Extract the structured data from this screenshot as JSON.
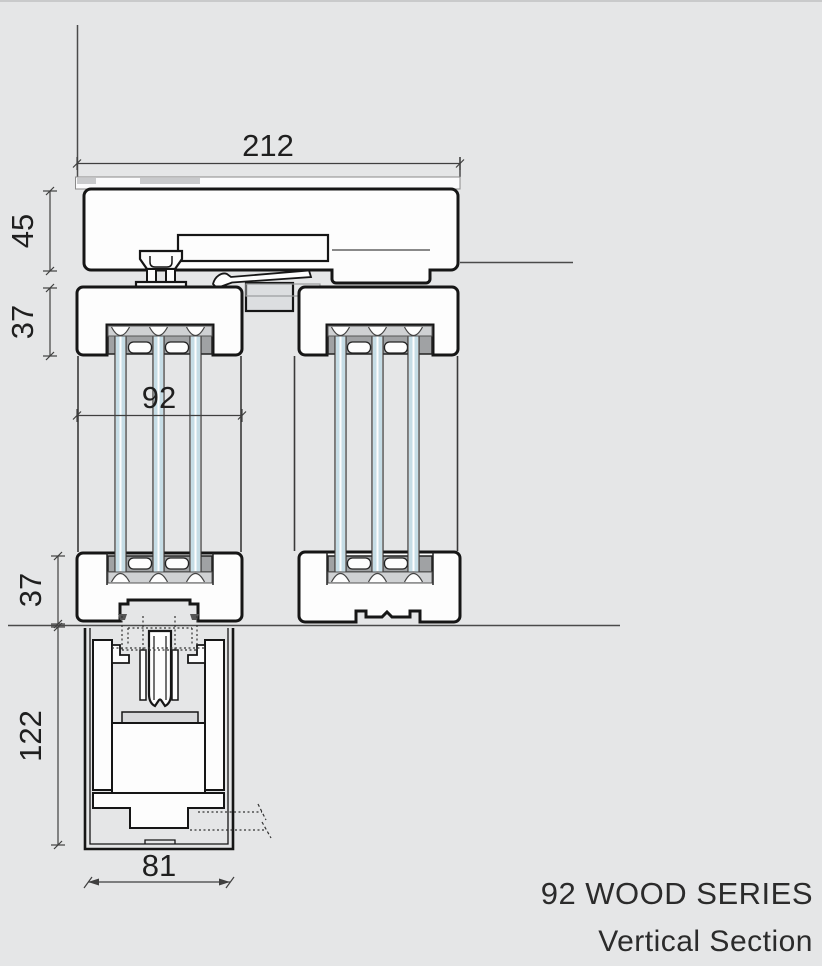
{
  "page": {
    "background": "#e5e6e7"
  },
  "drawing": {
    "type": "technical-vertical-section",
    "units": "mm",
    "dimensions": {
      "overall_width": "212",
      "head_frame_height": "45",
      "top_rail_height": "37",
      "sash_thickness": "92",
      "bottom_rail_height": "37",
      "sill_recess_depth": "122",
      "sill_channel_width": "81"
    },
    "title": {
      "series": "92 WOOD SERIES",
      "view": "Vertical Section"
    },
    "colors": {
      "outline": "#161616",
      "dimension": "#3f3f3f",
      "glass": "#c6dde6",
      "profile_fill": "#fdfdfd",
      "glazing_bridge": "#a0a2a4",
      "scallop_band": "#cfd1d3"
    }
  }
}
